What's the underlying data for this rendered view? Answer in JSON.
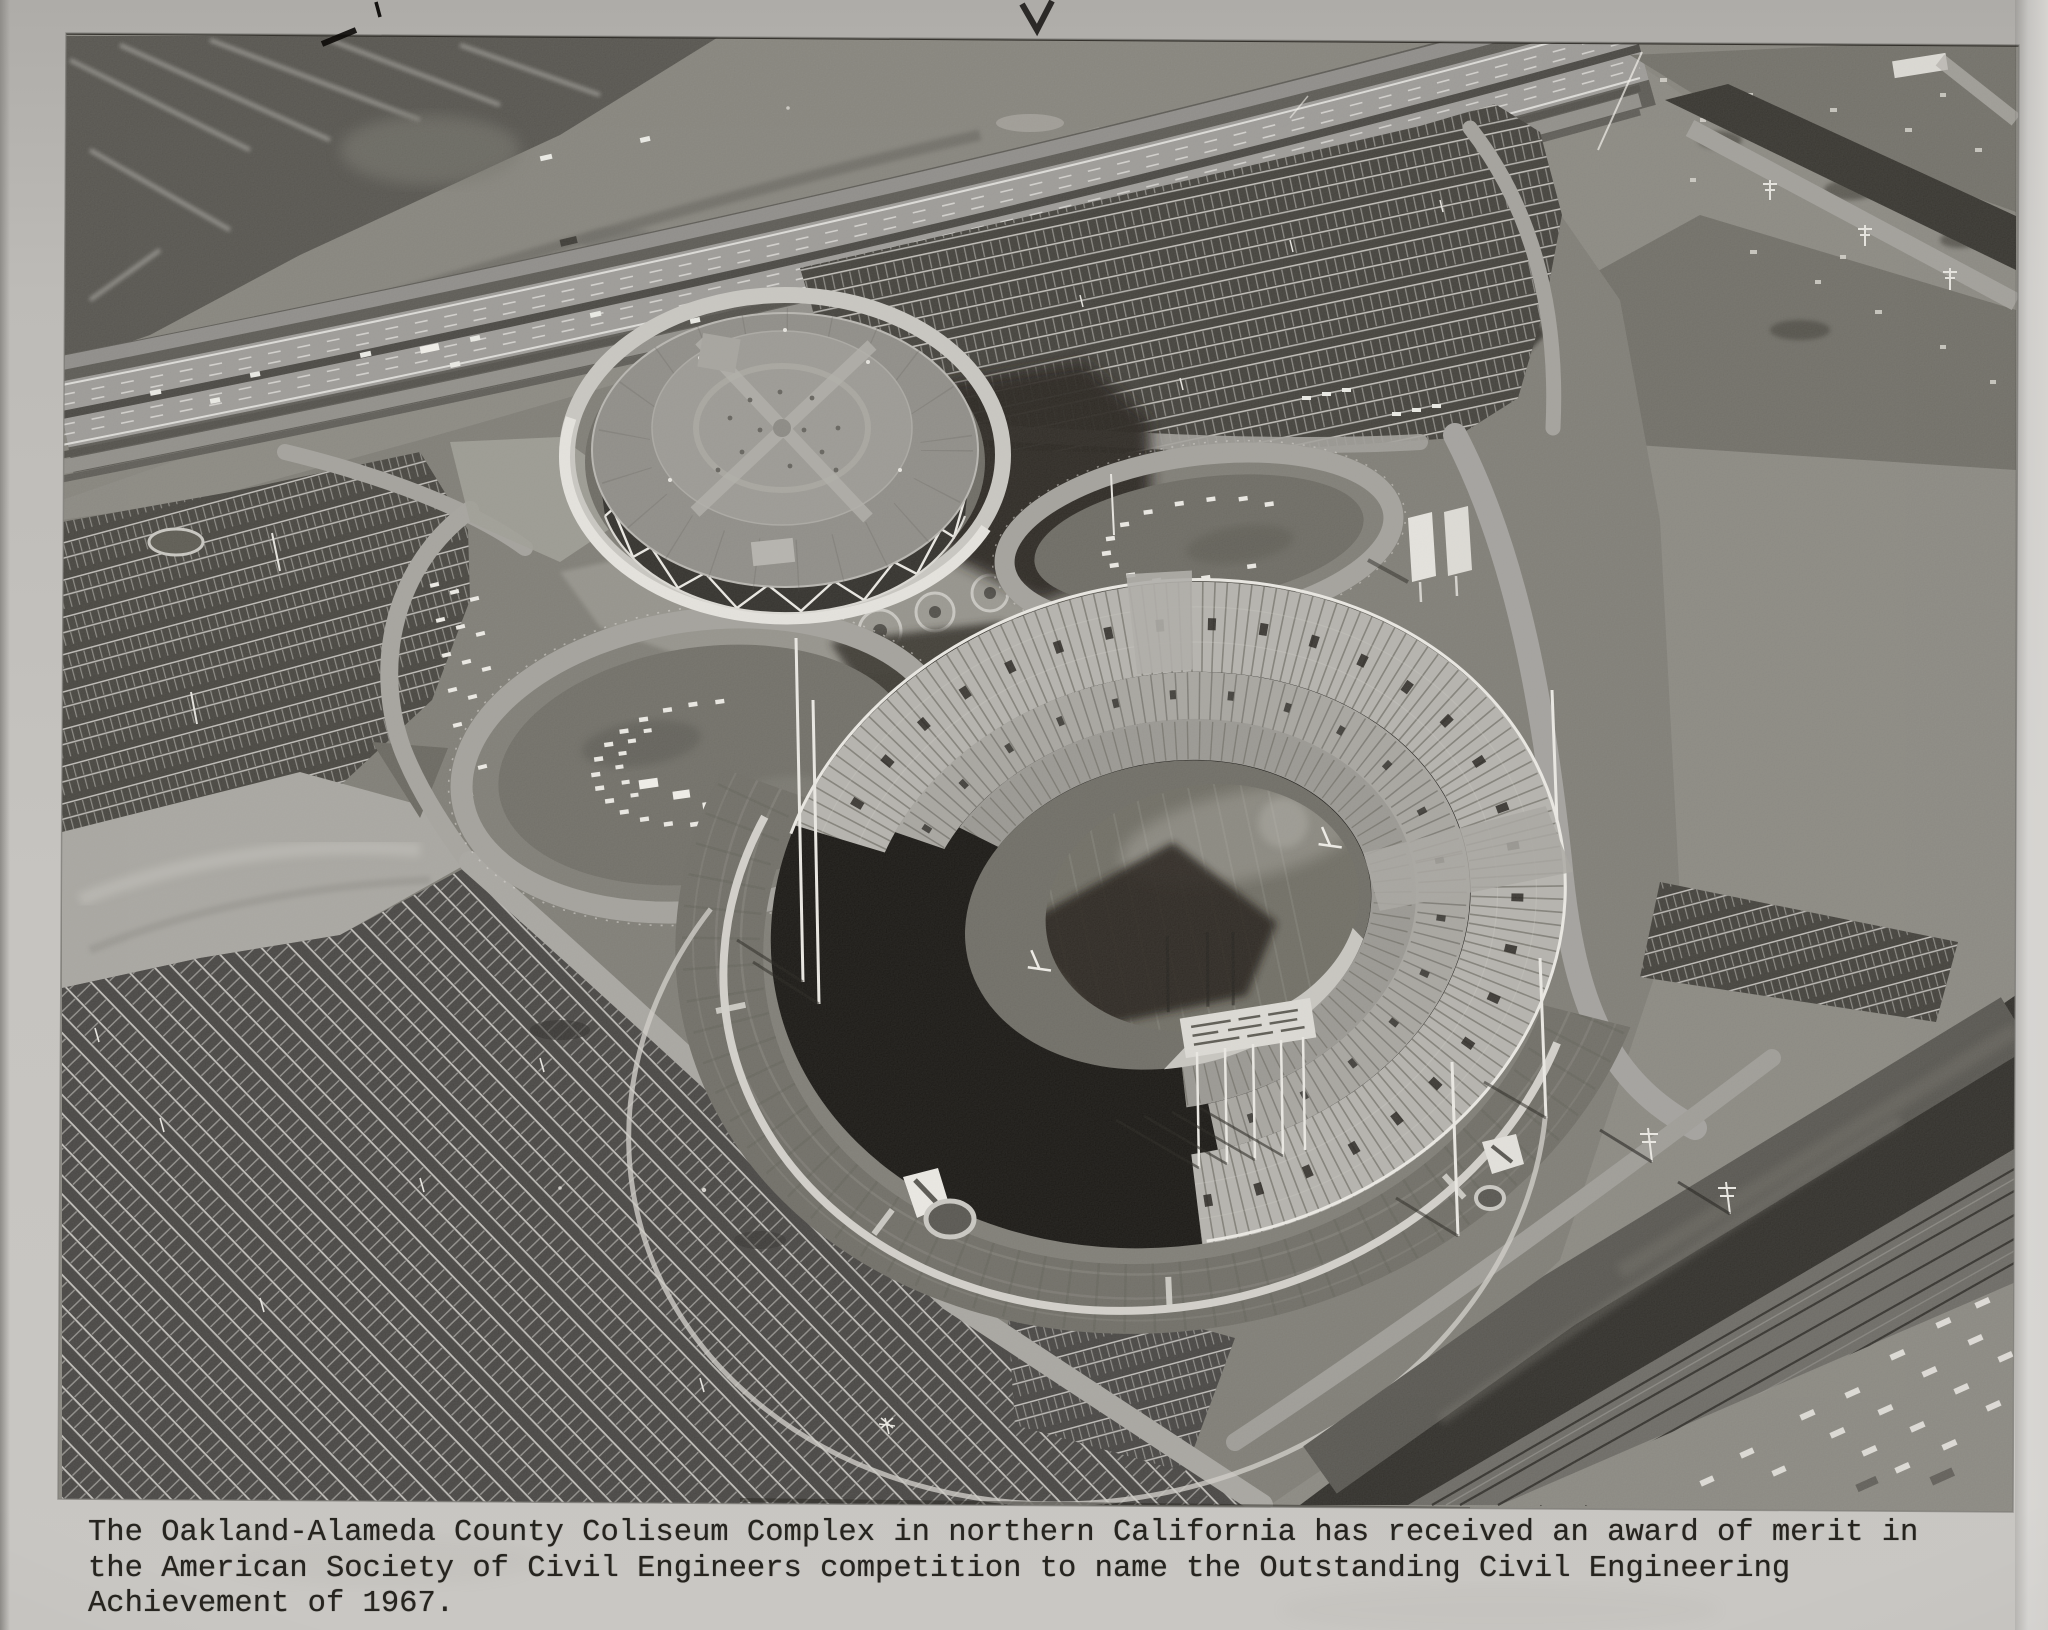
{
  "meta": {
    "type": "archival photograph mounted on gray paper",
    "subject": "Oakland-Alameda County Coliseum Complex, aerial view, 1967"
  },
  "caption": {
    "line1": "The Oakland-Alameda County Coliseum Complex in northern California has received an award of merit in",
    "line2": "the American Society of Civil Engineers competition to name the Outstanding Civil Engineering",
    "line3": "Achievement of 1967."
  },
  "photo": {
    "description": "Black-and-white aerial photograph: circular Oakland Arena with diamond-lattice wall beside the oval Coliseum stadium (football field inside, scoreboard casting a shadow), two elliptical landscaped traffic islands with parked cars, vast striped parking lots, the Nimitz Freeway crossing the top, marshland upper-left, a junkyard and canal upper-right, and a second canal, railroad tracks and lumber yards at lower right.",
    "regions": [
      "marshland",
      "nimitz-freeway",
      "junkyard",
      "canal-north",
      "oakland-arena",
      "coliseum-stadium",
      "football-field",
      "stadium-scoreboard",
      "north-parking-lots",
      "west-parking-lot",
      "south-parking-lot",
      "left-traffic-oval",
      "right-traffic-oval",
      "entry-plaza",
      "berm-walkways",
      "canal-south",
      "railroad-tracks",
      "industrial-yard"
    ]
  },
  "colors": {
    "paper": "#c6c4c0",
    "ink": "#26241f",
    "photo_dark": "#16140f",
    "photo_mid": "#8a8880",
    "photo_light": "#d8d6d0"
  }
}
